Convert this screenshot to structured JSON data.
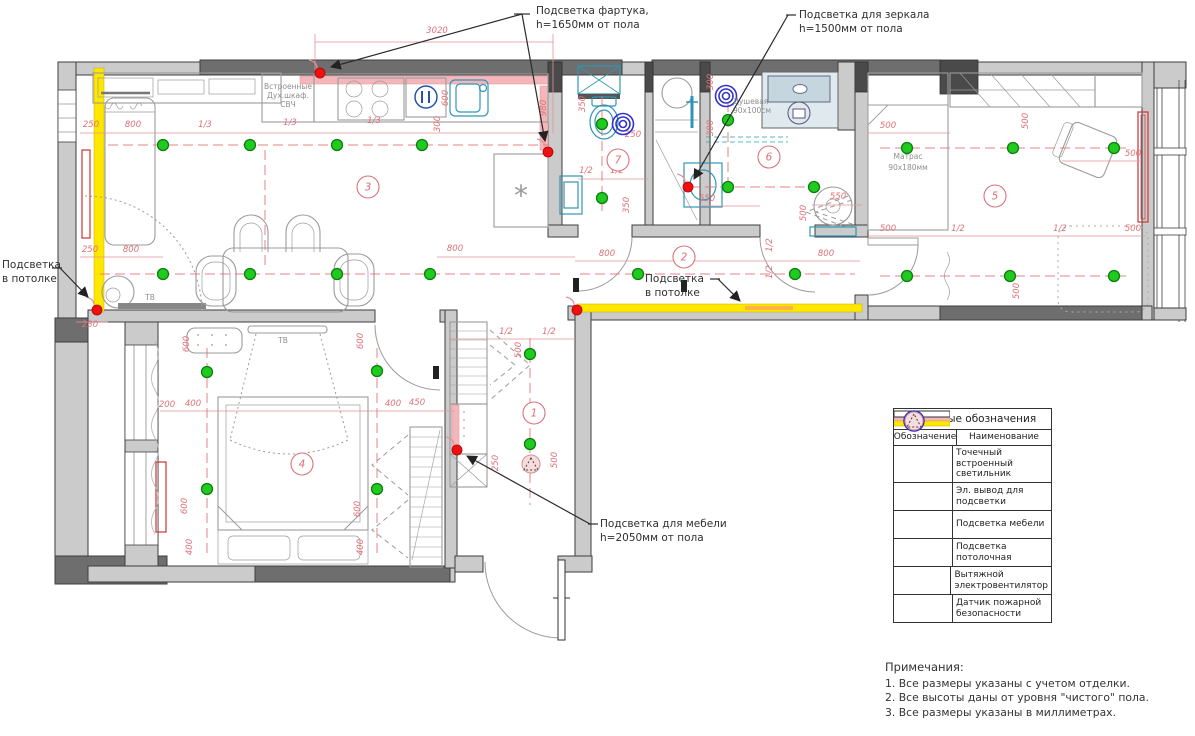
{
  "callouts": {
    "apron": [
      "Подсветка фартука,",
      "h=1650мм от пола"
    ],
    "mirror": [
      "Подсветка для зеркала",
      "h=1500мм от пола"
    ],
    "ceiling_left": [
      "Подсветка",
      "в потолке"
    ],
    "ceiling_corridor": [
      "Подсветка",
      "в потолке"
    ],
    "furniture": [
      "Подсветка для мебели",
      "h=2050мм от пола"
    ]
  },
  "room_labels": {
    "kitchen_appliances": [
      "Встроенные",
      "Дух.шкаф.",
      "СВЧ"
    ],
    "shower": [
      "Душевая",
      "90x100см"
    ],
    "mattress": [
      "Матрас",
      "90x180мм"
    ],
    "tv_living": "ТВ",
    "tv_bedroom": "ТВ"
  },
  "legend": {
    "title": "Условные обозначения",
    "col_symbol": "Обозначение",
    "col_name": "Наименование",
    "rows": [
      {
        "icon": "spot-light-icon",
        "label": "Точечный встроенный светильник"
      },
      {
        "icon": "electric-outlet-icon",
        "label": "Эл. вывод для подсветки"
      },
      {
        "icon": "furniture-light-icon",
        "label": "Подсветка мебели"
      },
      {
        "icon": "ceiling-light-icon",
        "label": "Подсветка потолочная"
      },
      {
        "icon": "exhaust-fan-icon",
        "label": "Вытяжной электровентилятор"
      },
      {
        "icon": "fire-sensor-icon",
        "label": "Датчик пожарной безопасности"
      }
    ]
  },
  "notes": {
    "title": "Примечания:",
    "items": [
      "1. Все размеры указаны с учетом отделки.",
      "2. Все высоты даны от уровня \"чистого\" пола.",
      "3. Все размеры указаны в миллиметрах."
    ]
  },
  "colors": {
    "spot_light": "#1ecb1e",
    "outlet": "#ef1010",
    "ceiling_strip": "#ffe800",
    "furniture_strip": "#f3b7bb",
    "fan": "#3232c8",
    "dims": "#dd7077",
    "walls": "#cbcbcb"
  },
  "plan": {
    "rooms": [
      {
        "n": "1",
        "x": 534,
        "y": 413
      },
      {
        "n": "2",
        "x": 684,
        "y": 257
      },
      {
        "n": "3",
        "x": 368,
        "y": 187
      },
      {
        "n": "4",
        "x": 302,
        "y": 464
      },
      {
        "n": "5",
        "x": 995,
        "y": 196
      },
      {
        "n": "6",
        "x": 769,
        "y": 157
      },
      {
        "n": "7",
        "x": 618,
        "y": 160
      }
    ],
    "lights": [
      [
        163,
        145
      ],
      [
        250,
        145
      ],
      [
        337,
        145
      ],
      [
        422,
        145
      ],
      [
        163,
        274
      ],
      [
        250,
        274
      ],
      [
        337,
        274
      ],
      [
        430,
        274
      ],
      [
        602,
        124
      ],
      [
        602,
        198
      ],
      [
        728,
        120
      ],
      [
        728,
        187
      ],
      [
        814,
        187
      ],
      [
        638,
        274
      ],
      [
        795,
        274
      ],
      [
        907,
        148
      ],
      [
        1013,
        148
      ],
      [
        1114,
        148
      ],
      [
        907,
        276
      ],
      [
        1010,
        276
      ],
      [
        1114,
        276
      ],
      [
        207,
        372
      ],
      [
        377,
        371
      ],
      [
        207,
        489
      ],
      [
        377,
        489
      ],
      [
        530,
        354
      ],
      [
        530,
        444
      ]
    ],
    "outlets": [
      [
        320,
        73
      ],
      [
        548,
        152
      ],
      [
        97,
        310
      ],
      [
        577,
        310
      ],
      [
        688,
        187
      ],
      [
        457,
        450
      ]
    ],
    "fans": [
      [
        623,
        124
      ],
      [
        726,
        96
      ]
    ],
    "fire_sensors": [
      [
        531,
        464
      ]
    ],
    "dims": [
      {
        "t": "3020",
        "x": 437,
        "y": 33
      },
      {
        "t": "250",
        "x": 91,
        "y": 127
      },
      {
        "t": "800",
        "x": 133,
        "y": 127
      },
      {
        "t": "1/3",
        "x": 205,
        "y": 127
      },
      {
        "t": "1/3",
        "x": 290,
        "y": 125
      },
      {
        "t": "1/3",
        "x": 374,
        "y": 123
      },
      {
        "t": "600",
        "x": 448,
        "y": 98,
        "r": -90
      },
      {
        "t": "300",
        "x": 440,
        "y": 124,
        "r": -90
      },
      {
        "t": "980",
        "x": 546,
        "y": 108,
        "r": -90
      },
      {
        "t": "250",
        "x": 90,
        "y": 252
      },
      {
        "t": "800",
        "x": 131,
        "y": 252
      },
      {
        "t": "230",
        "x": 90,
        "y": 327
      },
      {
        "t": "800",
        "x": 455,
        "y": 251
      },
      {
        "t": "800",
        "x": 607,
        "y": 256
      },
      {
        "t": "800",
        "x": 826,
        "y": 256
      },
      {
        "t": "1/2",
        "x": 772,
        "y": 245,
        "r": -90
      },
      {
        "t": "1/2",
        "x": 772,
        "y": 272,
        "r": -90
      },
      {
        "t": "350",
        "x": 585,
        "y": 104,
        "r": -90
      },
      {
        "t": "250",
        "x": 633,
        "y": 137
      },
      {
        "t": "1/2",
        "x": 586,
        "y": 173
      },
      {
        "t": "1/2",
        "x": 617,
        "y": 173
      },
      {
        "t": "350",
        "x": 629,
        "y": 205,
        "r": -90
      },
      {
        "t": "300",
        "x": 713,
        "y": 82,
        "r": -90
      },
      {
        "t": "300",
        "x": 713,
        "y": 128,
        "r": -90
      },
      {
        "t": "550",
        "x": 707,
        "y": 201
      },
      {
        "t": "550",
        "x": 838,
        "y": 199
      },
      {
        "t": "500",
        "x": 806,
        "y": 213,
        "r": -90
      },
      {
        "t": "500",
        "x": 888,
        "y": 128
      },
      {
        "t": "500",
        "x": 1028,
        "y": 121,
        "r": -90
      },
      {
        "t": "500",
        "x": 1133,
        "y": 156
      },
      {
        "t": "500",
        "x": 888,
        "y": 231
      },
      {
        "t": "1/2",
        "x": 958,
        "y": 231
      },
      {
        "t": "1/2",
        "x": 1060,
        "y": 231
      },
      {
        "t": "500",
        "x": 1133,
        "y": 231
      },
      {
        "t": "500",
        "x": 1019,
        "y": 291,
        "r": -90
      },
      {
        "t": "600",
        "x": 189,
        "y": 344,
        "r": -90
      },
      {
        "t": "600",
        "x": 363,
        "y": 341,
        "r": -90
      },
      {
        "t": "200",
        "x": 167,
        "y": 407
      },
      {
        "t": "400",
        "x": 193,
        "y": 406
      },
      {
        "t": "400",
        "x": 393,
        "y": 406
      },
      {
        "t": "450",
        "x": 417,
        "y": 405
      },
      {
        "t": "600",
        "x": 187,
        "y": 506,
        "r": -90
      },
      {
        "t": "600",
        "x": 360,
        "y": 509,
        "r": -90
      },
      {
        "t": "400",
        "x": 192,
        "y": 547,
        "r": -90
      },
      {
        "t": "400",
        "x": 363,
        "y": 547,
        "r": -90
      },
      {
        "t": "1/2",
        "x": 506,
        "y": 334
      },
      {
        "t": "1/2",
        "x": 549,
        "y": 334
      },
      {
        "t": "500",
        "x": 521,
        "y": 350,
        "r": -90
      },
      {
        "t": "500",
        "x": 557,
        "y": 460,
        "r": -90
      },
      {
        "t": "250",
        "x": 498,
        "y": 463,
        "r": -90
      }
    ],
    "dash_lines": [
      [
        108,
        145,
        548,
        145
      ],
      [
        100,
        274,
        560,
        274
      ],
      [
        265,
        150,
        265,
        268
      ],
      [
        580,
        274,
        855,
        274
      ],
      [
        602,
        96,
        602,
        212
      ],
      [
        690,
        187,
        810,
        187
      ],
      [
        728,
        102,
        728,
        183
      ],
      [
        880,
        148,
        1126,
        148
      ],
      [
        880,
        276,
        1126,
        276
      ],
      [
        207,
        348,
        207,
        558
      ],
      [
        377,
        348,
        377,
        558
      ],
      [
        530,
        338,
        530,
        505
      ]
    ],
    "dim_lines": [
      [
        315,
        42,
        553,
        42
      ],
      [
        315,
        34,
        315,
        70
      ],
      [
        553,
        34,
        553,
        133
      ],
      [
        80,
        133,
        548,
        133
      ],
      [
        80,
        257,
        163,
        257
      ],
      [
        437,
        257,
        575,
        257
      ],
      [
        575,
        261,
        860,
        261
      ],
      [
        868,
        133,
        950,
        133
      ],
      [
        1062,
        161,
        1140,
        161
      ],
      [
        868,
        236,
        1145,
        236
      ],
      [
        160,
        411,
        455,
        411
      ],
      [
        450,
        339,
        575,
        339
      ],
      [
        578,
        179,
        648,
        179
      ],
      [
        700,
        206,
        760,
        206
      ],
      [
        812,
        205,
        862,
        205
      ],
      [
        76,
        322,
        108,
        322
      ]
    ]
  }
}
